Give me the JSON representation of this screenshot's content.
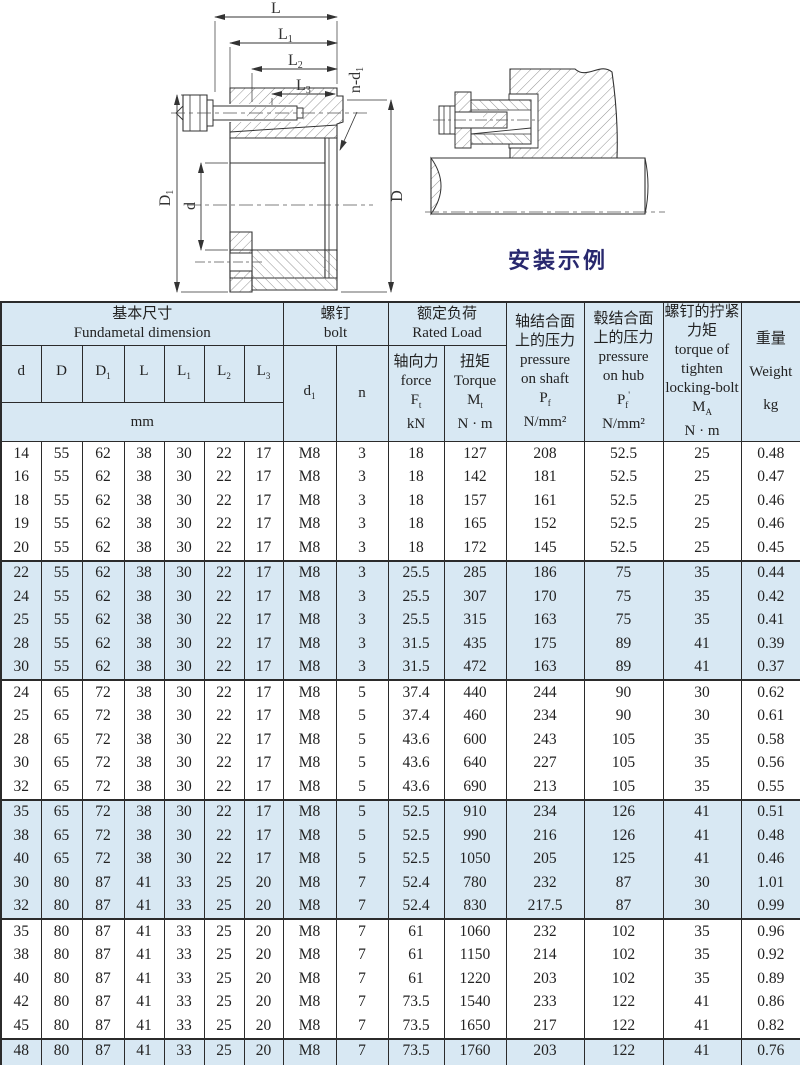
{
  "drawing": {
    "caption": "安装示例",
    "labels": {
      "L": {
        "sym": "L",
        "sub": ""
      },
      "L1": {
        "sym": "L",
        "sub": "1"
      },
      "L2": {
        "sym": "L",
        "sub": "2"
      },
      "L3": {
        "sym": "L",
        "sub": "3"
      },
      "nd1": {
        "sym": "n-d",
        "sub": "1"
      },
      "D1": {
        "sym": "D",
        "sub": "1"
      },
      "d": {
        "sym": "d",
        "sub": ""
      },
      "D": {
        "sym": "D",
        "sub": ""
      }
    }
  },
  "table": {
    "header": {
      "basic": {
        "zh": "基本尺寸",
        "en": "Fundametal  dimension",
        "unit": "mm"
      },
      "dim_cols": [
        {
          "sym": "d",
          "sub": ""
        },
        {
          "sym": "D",
          "sub": ""
        },
        {
          "sym": "D",
          "sub": "1"
        },
        {
          "sym": "L",
          "sub": ""
        },
        {
          "sym": "L",
          "sub": "1"
        },
        {
          "sym": "L",
          "sub": "2"
        },
        {
          "sym": "L",
          "sub": "3"
        }
      ],
      "bolt": {
        "zh": "螺钉",
        "en": "bolt",
        "d1": {
          "sym": "d",
          "sub": "1"
        },
        "n": "n"
      },
      "rated": {
        "zh": "额定负荷",
        "en": "Rated  Load"
      },
      "force": {
        "zh": "轴向力",
        "en": "force",
        "sym": "F",
        "sub": "t",
        "unit": "kN"
      },
      "torque": {
        "zh": "扭矩",
        "en": "Torque",
        "sym": "M",
        "sub": "t",
        "unit": "N · m"
      },
      "pressure_shaft": {
        "zh1": "轴结合面",
        "zh2": "上的压力",
        "en1": "pressure",
        "en2": "on  shaft",
        "sym": "P",
        "sub": "f",
        "unit": "N/mm²"
      },
      "pressure_hub": {
        "zh1": "毂结合面",
        "zh2": "上的压力",
        "en1": "pressure",
        "en2": "on hub",
        "sym": "P",
        "sub": "f",
        "prime": "'",
        "unit": "N/mm²"
      },
      "tighten": {
        "zh1": "螺钉的拧紧",
        "zh2": "力矩",
        "en1": "torque of",
        "en2": "tighten",
        "en3": "locking-bolt",
        "sym": "M",
        "sub": "A",
        "unit": "N · m"
      },
      "weight": {
        "zh": "重量",
        "en": "Weight",
        "unit": "kg"
      }
    },
    "groups": [
      {
        "rows": [
          [
            "14",
            "55",
            "62",
            "38",
            "30",
            "22",
            "17",
            "M8",
            "3",
            "18",
            "127",
            "208",
            "52.5",
            "25",
            "0.48"
          ],
          [
            "16",
            "55",
            "62",
            "38",
            "30",
            "22",
            "17",
            "M8",
            "3",
            "18",
            "142",
            "181",
            "52.5",
            "25",
            "0.47"
          ],
          [
            "18",
            "55",
            "62",
            "38",
            "30",
            "22",
            "17",
            "M8",
            "3",
            "18",
            "157",
            "161",
            "52.5",
            "25",
            "0.46"
          ],
          [
            "19",
            "55",
            "62",
            "38",
            "30",
            "22",
            "17",
            "M8",
            "3",
            "18",
            "165",
            "152",
            "52.5",
            "25",
            "0.46"
          ],
          [
            "20",
            "55",
            "62",
            "38",
            "30",
            "22",
            "17",
            "M8",
            "3",
            "18",
            "172",
            "145",
            "52.5",
            "25",
            "0.45"
          ]
        ]
      },
      {
        "rows": [
          [
            "22",
            "55",
            "62",
            "38",
            "30",
            "22",
            "17",
            "M8",
            "3",
            "25.5",
            "285",
            "186",
            "75",
            "35",
            "0.44"
          ],
          [
            "24",
            "55",
            "62",
            "38",
            "30",
            "22",
            "17",
            "M8",
            "3",
            "25.5",
            "307",
            "170",
            "75",
            "35",
            "0.42"
          ],
          [
            "25",
            "55",
            "62",
            "38",
            "30",
            "22",
            "17",
            "M8",
            "3",
            "25.5",
            "315",
            "163",
            "75",
            "35",
            "0.41"
          ],
          [
            "28",
            "55",
            "62",
            "38",
            "30",
            "22",
            "17",
            "M8",
            "3",
            "31.5",
            "435",
            "175",
            "89",
            "41",
            "0.39"
          ],
          [
            "30",
            "55",
            "62",
            "38",
            "30",
            "22",
            "17",
            "M8",
            "3",
            "31.5",
            "472",
            "163",
            "89",
            "41",
            "0.37"
          ]
        ]
      },
      {
        "rows": [
          [
            "24",
            "65",
            "72",
            "38",
            "30",
            "22",
            "17",
            "M8",
            "5",
            "37.4",
            "440",
            "244",
            "90",
            "30",
            "0.62"
          ],
          [
            "25",
            "65",
            "72",
            "38",
            "30",
            "22",
            "17",
            "M8",
            "5",
            "37.4",
            "460",
            "234",
            "90",
            "30",
            "0.61"
          ],
          [
            "28",
            "65",
            "72",
            "38",
            "30",
            "22",
            "17",
            "M8",
            "5",
            "43.6",
            "600",
            "243",
            "105",
            "35",
            "0.58"
          ],
          [
            "30",
            "65",
            "72",
            "38",
            "30",
            "22",
            "17",
            "M8",
            "5",
            "43.6",
            "640",
            "227",
            "105",
            "35",
            "0.56"
          ],
          [
            "32",
            "65",
            "72",
            "38",
            "30",
            "22",
            "17",
            "M8",
            "5",
            "43.6",
            "690",
            "213",
            "105",
            "35",
            "0.55"
          ]
        ]
      },
      {
        "rows": [
          [
            "35",
            "65",
            "72",
            "38",
            "30",
            "22",
            "17",
            "M8",
            "5",
            "52.5",
            "910",
            "234",
            "126",
            "41",
            "0.51"
          ],
          [
            "38",
            "65",
            "72",
            "38",
            "30",
            "22",
            "17",
            "M8",
            "5",
            "52.5",
            "990",
            "216",
            "126",
            "41",
            "0.48"
          ],
          [
            "40",
            "65",
            "72",
            "38",
            "30",
            "22",
            "17",
            "M8",
            "5",
            "52.5",
            "1050",
            "205",
            "125",
            "41",
            "0.46"
          ],
          [
            "30",
            "80",
            "87",
            "41",
            "33",
            "25",
            "20",
            "M8",
            "7",
            "52.4",
            "780",
            "232",
            "87",
            "30",
            "1.01"
          ],
          [
            "32",
            "80",
            "87",
            "41",
            "33",
            "25",
            "20",
            "M8",
            "7",
            "52.4",
            "830",
            "217.5",
            "87",
            "30",
            "0.99"
          ]
        ]
      },
      {
        "rows": [
          [
            "35",
            "80",
            "87",
            "41",
            "33",
            "25",
            "20",
            "M8",
            "7",
            "61",
            "1060",
            "232",
            "102",
            "35",
            "0.96"
          ],
          [
            "38",
            "80",
            "87",
            "41",
            "33",
            "25",
            "20",
            "M8",
            "7",
            "61",
            "1150",
            "214",
            "102",
            "35",
            "0.92"
          ],
          [
            "40",
            "80",
            "87",
            "41",
            "33",
            "25",
            "20",
            "M8",
            "7",
            "61",
            "1220",
            "203",
            "102",
            "35",
            "0.89"
          ],
          [
            "42",
            "80",
            "87",
            "41",
            "33",
            "25",
            "20",
            "M8",
            "7",
            "73.5",
            "1540",
            "233",
            "122",
            "41",
            "0.86"
          ],
          [
            "45",
            "80",
            "87",
            "41",
            "33",
            "25",
            "20",
            "M8",
            "7",
            "73.5",
            "1650",
            "217",
            "122",
            "41",
            "0.82"
          ]
        ]
      },
      {
        "rows": [
          [
            "48",
            "80",
            "87",
            "41",
            "33",
            "25",
            "20",
            "M8",
            "7",
            "73.5",
            "1760",
            "203",
            "122",
            "41",
            "0.76"
          ],
          [
            "50",
            "80",
            "87",
            "41",
            "33",
            "25",
            "20",
            "M8",
            "7",
            "73.5",
            "1830",
            "195",
            "122",
            "41",
            "0.73"
          ]
        ]
      }
    ]
  }
}
